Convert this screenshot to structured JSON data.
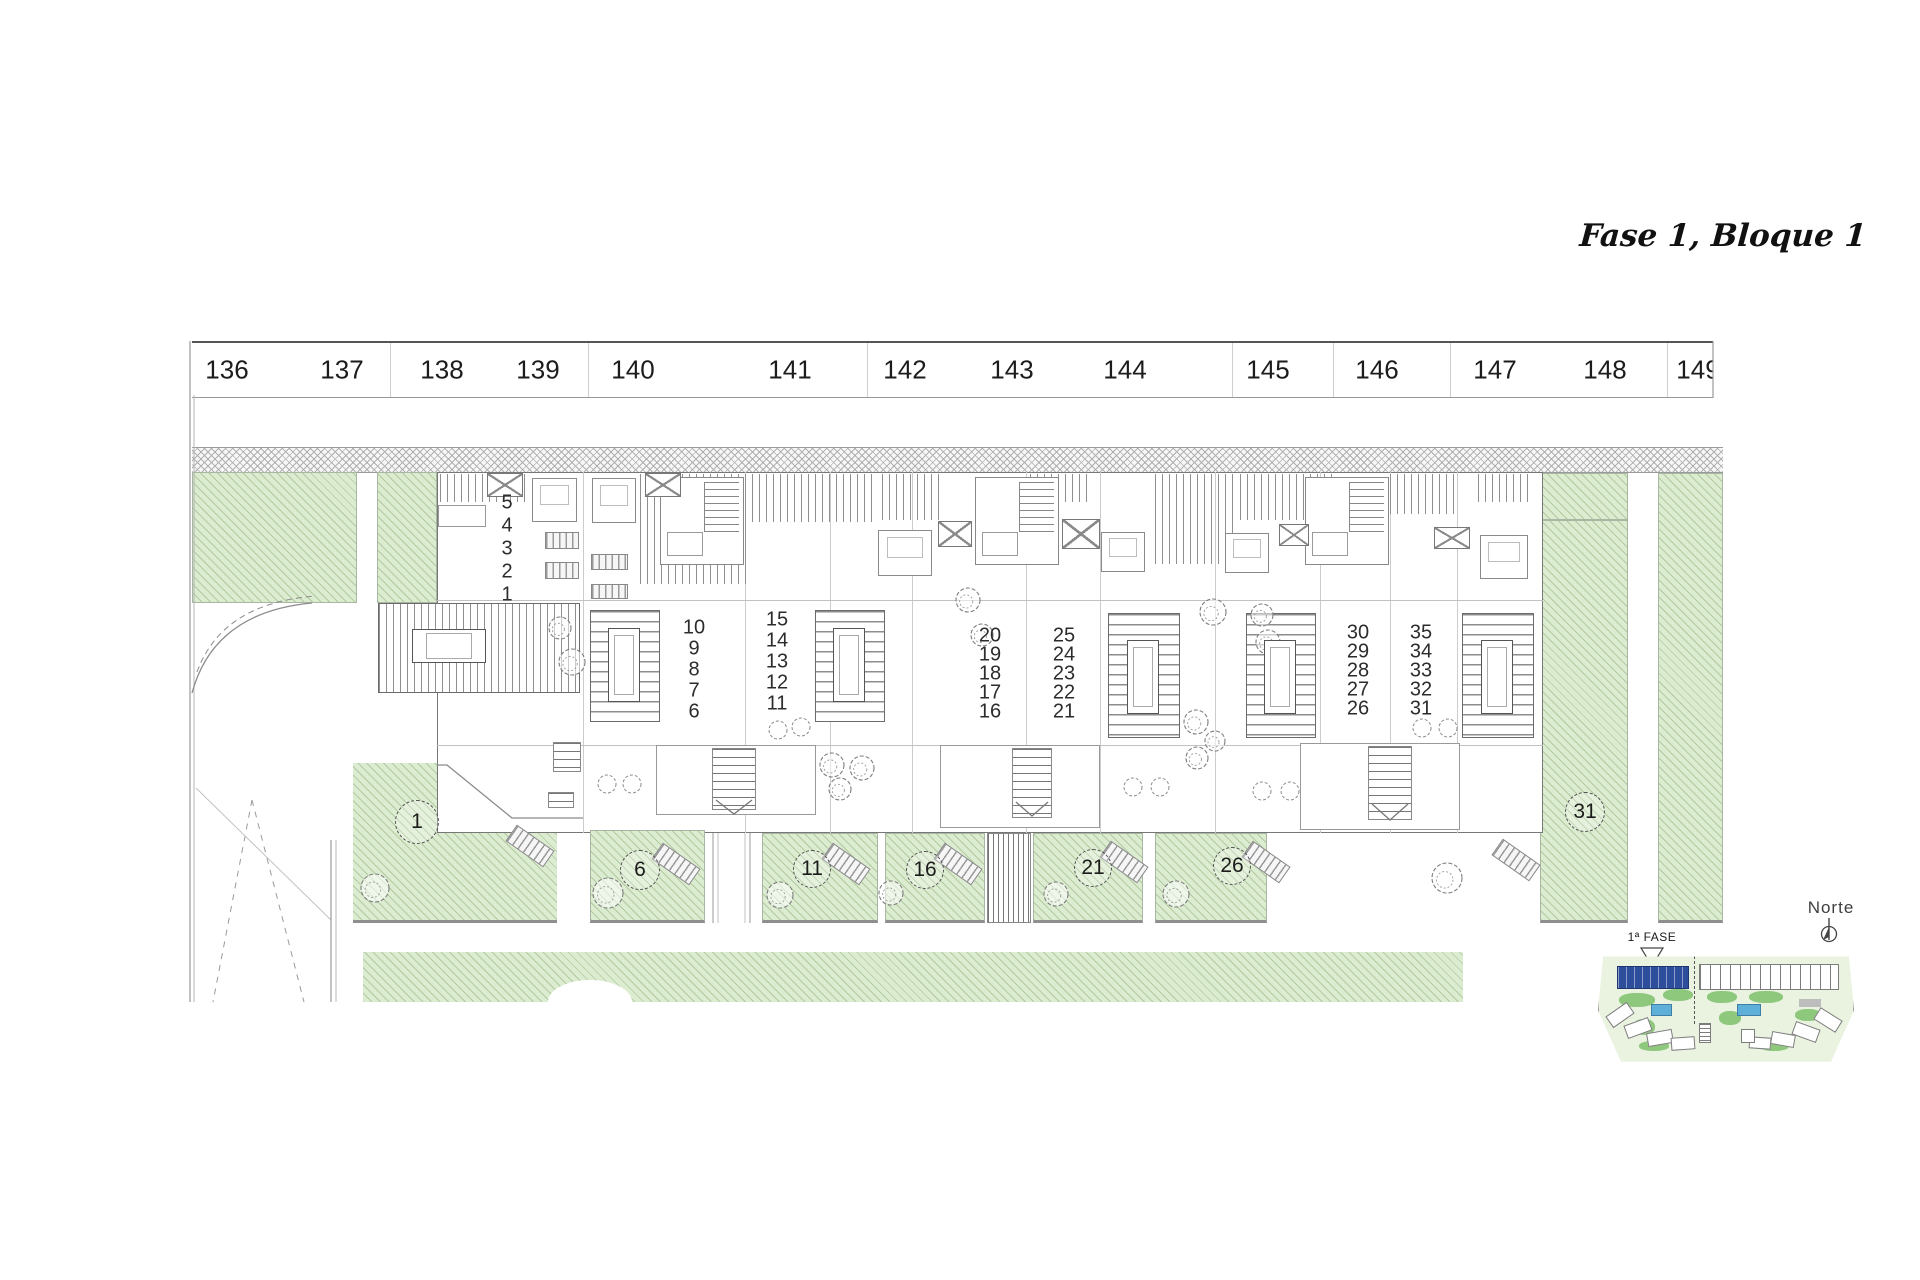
{
  "title": "Fase 1, Bloque 1",
  "ruler": {
    "numbers": [
      "136",
      "137",
      "138",
      "139",
      "140",
      "141",
      "142",
      "143",
      "144",
      "145",
      "146",
      "147",
      "148",
      "149"
    ]
  },
  "building": {
    "unit_columns": [
      {
        "units": [
          "5",
          "4",
          "3",
          "2",
          "1"
        ]
      },
      {
        "units": [
          "10",
          "9",
          "8",
          "7",
          "6"
        ]
      },
      {
        "units": [
          "15",
          "14",
          "13",
          "12",
          "11"
        ]
      },
      {
        "units": [
          "20",
          "19",
          "18",
          "17",
          "16"
        ]
      },
      {
        "units": [
          "25",
          "24",
          "23",
          "22",
          "21"
        ]
      },
      {
        "units": [
          "30",
          "29",
          "28",
          "27",
          "26"
        ]
      },
      {
        "units": [
          "35",
          "34",
          "33",
          "32",
          "31"
        ]
      }
    ]
  },
  "plots": {
    "labels": [
      "1",
      "6",
      "11",
      "16",
      "21",
      "26",
      "31"
    ]
  },
  "minimap": {
    "phase_label": "1ª FASE",
    "north_label": "Norte"
  },
  "colors": {
    "green_fill": "#dcecd0",
    "hatch_line": "#7da069",
    "line_gray": "#8a8a8a",
    "highlight_blue": "#2e4d9b",
    "pool_blue": "#5fb0d8",
    "map_green": "#7cc06a"
  }
}
